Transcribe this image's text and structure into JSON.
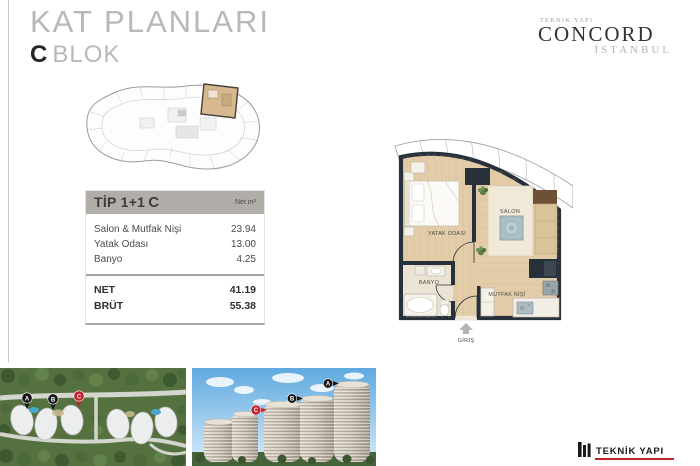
{
  "header": {
    "title": "KAT PLANLARI",
    "block_letter": "C",
    "block_word": "BLOK"
  },
  "brand_top": {
    "small": "TEKNİK YAPI",
    "name": "CONCORD",
    "sub": "İSTANBUL"
  },
  "unit_table": {
    "title": "TİP 1+1",
    "title_block": "C",
    "unit_label": "Net m²",
    "rows": [
      {
        "label": "Salon & Mutfak Nişi",
        "value": "23.94"
      },
      {
        "label": "Yatak Odası",
        "value": "13.00"
      },
      {
        "label": "Banyo",
        "value": "4.25"
      }
    ],
    "totals": [
      {
        "label": "NET",
        "value": "41.19"
      },
      {
        "label": "BRÜT",
        "value": "55.38"
      }
    ]
  },
  "floor_plan": {
    "labels": {
      "bedroom": "YATAK ODASI",
      "living": "SALON",
      "bath": "BANYO",
      "kitchen": "MUTFAK NİŞİ",
      "entrance": "GİRİŞ"
    }
  },
  "site_map": {
    "marker_a": "A",
    "marker_b": "B",
    "marker_c": "C"
  },
  "towers": {
    "marker_a": "A",
    "marker_b": "B",
    "marker_c": "C"
  },
  "brand_bottom": {
    "name": "TEKNİK YAPI"
  },
  "colors": {
    "accent_red": "#c2232a",
    "wall_dark": "#27313c",
    "floor_tan": "#e3cda8",
    "table_header_gray": "#b1aeaa"
  }
}
